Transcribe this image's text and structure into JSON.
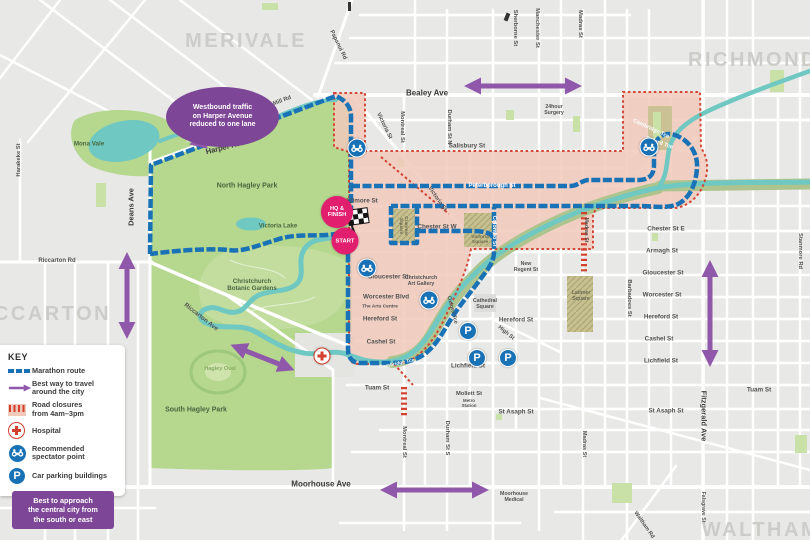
{
  "colors": {
    "bg": "#e8e8e6",
    "street": "#ffffff",
    "park": "#b5d78e",
    "park_light": "#c9e0a6",
    "gardens": "#c3dd9e",
    "river": "#6fc8c1",
    "closure_fill": "#f1c9bb",
    "closure_red": "#d2402e",
    "route_blue": "#1a72b6",
    "arrow_purple": "#9058aa",
    "callout_purple": "#7d4696",
    "badge_pink": "#e21e6e",
    "suburb_gray": "#ccccc8",
    "label_gray": "#525252",
    "khaki": "#c6c08f",
    "olive_band": "#aec48e",
    "hospital_red": "#d2402e"
  },
  "glyphs": {
    "parking": "P"
  },
  "legend": {
    "title": "KEY",
    "items": [
      {
        "label": "Marathon route"
      },
      {
        "label": "Best way to travel\naround the city"
      },
      {
        "label": "Road closures\nfrom 4am–3pm"
      },
      {
        "label": "Hospital"
      },
      {
        "label": "Recommended\nspectator point"
      },
      {
        "label": "Car parking buildings"
      }
    ],
    "note": "Best to approach\nthe central city from\nthe south or east"
  },
  "callouts": {
    "harper": "Westbound traffic\non Harper Avenue\nreduced to one lane"
  },
  "map": {
    "markers": {
      "hq_finish": "HQ &\nFINISH",
      "start": "START"
    },
    "suburbs": [
      {
        "text": "MERIVALE",
        "x": 246,
        "y": 41
      },
      {
        "text": "RICHMOND",
        "x": 753,
        "y": 60
      },
      {
        "text": "RICCARTON",
        "x": 40,
        "y": 314
      },
      {
        "text": "WALTHAM",
        "x": 761,
        "y": 530
      }
    ],
    "street_labels": [
      {
        "text": "Bealey Ave",
        "x": 427,
        "y": 93,
        "size": 8,
        "color": "#3a3a3a"
      },
      {
        "text": "Moorhouse Ave",
        "x": 321,
        "y": 484,
        "size": 8,
        "color": "#3a3a3a"
      },
      {
        "text": "Harper Ave",
        "x": 225,
        "y": 147,
        "rotate": -14,
        "size": 7.5,
        "color": "#3a3a3a"
      },
      {
        "text": "Deans Ave",
        "x": 131,
        "y": 207,
        "rotate": -90,
        "size": 7.5,
        "color": "#3a3a3a"
      },
      {
        "text": "Fitzgerald Ave",
        "x": 704,
        "y": 416,
        "rotate": 90,
        "size": 7.5,
        "color": "#3a3a3a"
      },
      {
        "text": "Salisbury St",
        "x": 467,
        "y": 146
      },
      {
        "text": "Kilmore St",
        "x": 362,
        "y": 201
      },
      {
        "text": "Chester St W",
        "x": 437,
        "y": 227
      },
      {
        "text": "Chester St E",
        "x": 666,
        "y": 229
      },
      {
        "text": "Armagh St",
        "x": 662,
        "y": 251
      },
      {
        "text": "Gloucester St",
        "x": 663,
        "y": 273
      },
      {
        "text": "Worcester St",
        "x": 662,
        "y": 295
      },
      {
        "text": "Hereford St",
        "x": 661,
        "y": 317
      },
      {
        "text": "Cashel St",
        "x": 659,
        "y": 339
      },
      {
        "text": "Lichfield St",
        "x": 661,
        "y": 361
      },
      {
        "text": "Tuam St",
        "x": 759,
        "y": 390
      },
      {
        "text": "St Asaph St",
        "x": 666,
        "y": 411
      },
      {
        "text": "Gloucester St",
        "x": 388,
        "y": 277
      },
      {
        "text": "Worcester Blvd",
        "x": 386,
        "y": 297
      },
      {
        "text": "The Arts Centre",
        "x": 380,
        "y": 307,
        "size": 4.8
      },
      {
        "text": "Hereford St",
        "x": 380,
        "y": 319
      },
      {
        "text": "Cashel St",
        "x": 381,
        "y": 342
      },
      {
        "text": "Tuam St",
        "x": 377,
        "y": 388
      },
      {
        "text": "Lichfield St",
        "x": 468,
        "y": 366
      },
      {
        "text": "Mollett St",
        "x": 469,
        "y": 394,
        "size": 5.8
      },
      {
        "text": "Metro\nStation",
        "x": 469,
        "y": 403,
        "size": 4.4
      },
      {
        "text": "St Asaph St",
        "x": 516,
        "y": 412
      },
      {
        "text": "Hereford St",
        "x": 516,
        "y": 320
      },
      {
        "text": "High St",
        "x": 506,
        "y": 333,
        "rotate": 40,
        "size": 5.5
      },
      {
        "text": "Riccarton Rd",
        "x": 57,
        "y": 261,
        "size": 6
      },
      {
        "text": "Riccarton Ave",
        "x": 201,
        "y": 317,
        "rotate": 38,
        "size": 6.2
      },
      {
        "text": "Peterborough St",
        "x": 492,
        "y": 186,
        "size": 6,
        "color": "#ffffff"
      },
      {
        "text": "Colombo St",
        "x": 494,
        "y": 231,
        "rotate": 90,
        "size": 5.5,
        "color": "#ffffff"
      },
      {
        "text": "Carlton Mill Rd",
        "x": 272,
        "y": 105,
        "rotate": -21,
        "size": 5.8
      },
      {
        "text": "Papanui Rd",
        "x": 338,
        "y": 45,
        "rotate": 64,
        "size": 5.8
      },
      {
        "text": "Victoria St",
        "x": 384,
        "y": 126,
        "rotate": 64,
        "size": 5.8
      },
      {
        "text": "Victoria St",
        "x": 437,
        "y": 199,
        "rotate": 55,
        "size": 5.8
      },
      {
        "text": "Oxford Tce",
        "x": 452,
        "y": 310,
        "rotate": 75,
        "size": 5.5
      },
      {
        "text": "Cambridge Tce",
        "x": 651,
        "y": 129,
        "rotate": 25,
        "size": 5.5,
        "color": "#ffffff"
      },
      {
        "text": "Oxford Tce",
        "x": 659,
        "y": 143,
        "rotate": 20,
        "size": 5.5,
        "color": "#ffffff"
      },
      {
        "text": "Cambridge Tce",
        "x": 397,
        "y": 364,
        "rotate": -12,
        "size": 5,
        "color": "#f2f5ea"
      },
      {
        "text": "Waltham Rd",
        "x": 644,
        "y": 525,
        "rotate": 55,
        "size": 5.5
      },
      {
        "text": "Montreal St",
        "x": 402,
        "y": 127,
        "rotate": 90,
        "size": 5.8
      },
      {
        "text": "Durham St N",
        "x": 449,
        "y": 127,
        "rotate": 90,
        "size": 5.8
      },
      {
        "text": "Sherborne St",
        "x": 515,
        "y": 28,
        "rotate": 90,
        "size": 5.8
      },
      {
        "text": "Manchester St",
        "x": 537,
        "y": 28,
        "rotate": 90,
        "size": 5.8
      },
      {
        "text": "Madras St",
        "x": 580,
        "y": 24,
        "rotate": 90,
        "size": 5.8
      },
      {
        "text": "Harakeke St",
        "x": 19,
        "y": 160,
        "rotate": -90,
        "size": 5.8
      },
      {
        "text": "Barbadoes St",
        "x": 629,
        "y": 298,
        "rotate": 90,
        "size": 5.8
      },
      {
        "text": "Stanmore Rd",
        "x": 800,
        "y": 251,
        "rotate": 90,
        "size": 5.8
      },
      {
        "text": "Madras St",
        "x": 586,
        "y": 230,
        "rotate": 90,
        "size": 5.2
      },
      {
        "text": "Montreal St",
        "x": 404,
        "y": 442,
        "rotate": 90,
        "size": 5.8
      },
      {
        "text": "Durham St S",
        "x": 447,
        "y": 438,
        "rotate": 90,
        "size": 5.8
      },
      {
        "text": "Madras St",
        "x": 584,
        "y": 444,
        "rotate": 90,
        "size": 5.5
      },
      {
        "text": "Falsgrave St",
        "x": 703,
        "y": 507,
        "rotate": 90,
        "size": 5.2
      },
      {
        "text": "North Hagley Park",
        "x": 247,
        "y": 186,
        "size": 7,
        "color": "#4a6840"
      },
      {
        "text": "South Hagley Park",
        "x": 196,
        "y": 410,
        "size": 7,
        "color": "#4a6840"
      },
      {
        "text": "Victoria Lake",
        "x": 278,
        "y": 226,
        "size": 6.2,
        "color": "#4a6840"
      },
      {
        "text": "Christchurch\nBotanic Gardens",
        "x": 252,
        "y": 285,
        "size": 6.2,
        "color": "#4a6840"
      },
      {
        "text": "Hagley Oval",
        "x": 220,
        "y": 369,
        "size": 5.5,
        "color": "#87ad65"
      },
      {
        "text": "Mona Vale",
        "x": 89,
        "y": 144,
        "size": 6.2,
        "color": "#4a6840"
      },
      {
        "text": "Christchurch\nArt Gallery",
        "x": 421,
        "y": 281,
        "size": 5.2
      },
      {
        "text": "Cathedral\nSquare",
        "x": 485,
        "y": 304,
        "size": 5.2
      },
      {
        "text": "New\nRegent St",
        "x": 526,
        "y": 267,
        "size": 5.2
      },
      {
        "text": "Latimer\nSquare",
        "x": 581,
        "y": 296,
        "size": 5.2,
        "color": "#6b6b52"
      },
      {
        "text": "Victoria\nSquare",
        "x": 480,
        "y": 240,
        "size": 4.8,
        "color": "#6b6b52"
      },
      {
        "text": "Cranmer\nSquare",
        "x": 403,
        "y": 226,
        "rotate": 90,
        "size": 4.8,
        "color": "#6b6b52"
      },
      {
        "text": "24hour\nSurgery",
        "x": 554,
        "y": 110,
        "size": 5.2
      },
      {
        "text": "Moorhouse\nMedical",
        "x": 514,
        "y": 497,
        "size": 5.2
      }
    ],
    "icons": [
      {
        "type": "spectator",
        "x": 357,
        "y": 148
      },
      {
        "type": "spectator",
        "x": 367,
        "y": 268
      },
      {
        "type": "spectator",
        "x": 429,
        "y": 300
      },
      {
        "type": "spectator",
        "x": 649,
        "y": 147
      },
      {
        "type": "parking",
        "x": 468,
        "y": 331
      },
      {
        "type": "parking",
        "x": 477,
        "y": 358
      },
      {
        "type": "parking",
        "x": 508,
        "y": 358
      },
      {
        "type": "hospital",
        "x": 322,
        "y": 356
      }
    ]
  }
}
